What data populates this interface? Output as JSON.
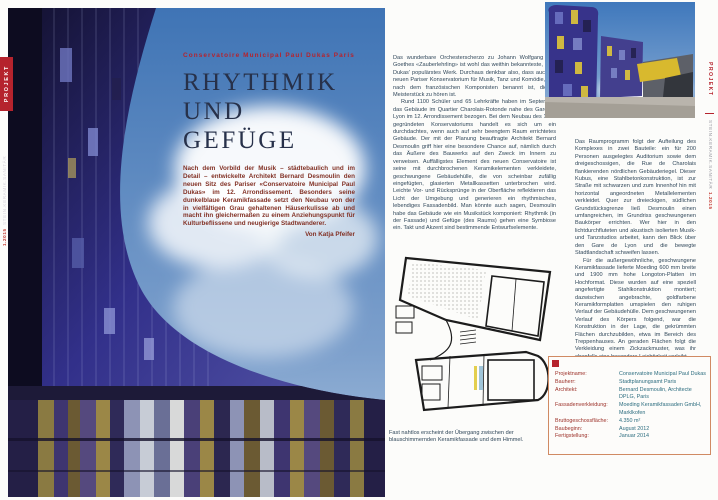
{
  "magazine": {
    "section_tab": "PROJEKT",
    "spine_name": "STEIN.KERAMIK.SANITÄR",
    "spine_issue": "1.2015"
  },
  "left_page": {
    "kicker": "Conservatoire Municipal Paul Dukas Paris",
    "title_line1": "RHYTHMIK",
    "title_line2": "UND GEFÜGE",
    "intro": "Nach dem Vorbild der Musik – städtebaulich und im Detail – entwickelte Architekt Bernard Desmoulin den neuen Sitz des Pariser «Conservatoire Municipal Paul Dukas» im 12. Arrondissement. Besonders seine dunkelblaue Keramikfassade setzt den Neubau von der in vielfältigen Grau gehaltenen Häuserkulisse ab und macht ihn gleichermaßen zu einem Anziehungspunkt für Kulturbeflissene und neugierige Stadtwanderer.",
    "byline": "Von Katja Pfeifer"
  },
  "right_page": {
    "col1_paras": [
      "Das wunderbare Orchesterscherzo zu Johann Wolfgang von Goethes «Zauberlehrling» ist wohl das weithin bekannteste, Paul Dukas' populärstes Werk. Durchaus denkbar also, dass auch im neuen Pariser Konservatorium für Musik, Tanz und Komödie, das nach dem französischen Komponisten benannt ist, dieses Meisterstück zu hören ist.",
      "Rund 1100 Schüler und 65 Lehrkräfte haben im September das Gebäude im Quartier Charolais-Rotonde nahe des Gare de Lyon im 12. Arrondissement bezogen. Bei dem Neubau des 1955 gegründeten Konservatoriums handelt es sich um ein durchdachtes, wenn auch auf sehr beengtem Raum errichtetes Gebäude. Der mit der Planung beauftragte Architekt Bernard Desmoulin griff hier eine besondere Chance auf, nämlich durch das Äußere des Bauwerks auf den Zweck im Innern zu verweisen. Auffälligstes Element des neuen Conservatoire ist seine mit durchbrochenen Keramikelementen verkleidete, geschwungene Gebäudehülle, die von scheinbar zufällig eingefügten, glasierten Metallkassetten unterbrochen wird. Leichte Vor- und Rücksprünge in der Oberfläche reflektieren das Licht der Umgebung und generieren ein rhythmisches, lebendiges Fassadenbild. Man könnte auch sagen, Desmoulin habe das Gebäude wie ein Musikstück komponiert: Rhythmik (in der Fassade) und Gefüge (des Raums) gehen eine Symbiose ein. Takt und Akzent sind bestimmende Entwurfselemente."
    ],
    "col2_paras": [
      "Das Raumprogramm folgt der Aufteilung des Komplexes in zwei Bauteile: ein für 200 Personen ausgelegtes Auditorium sowie dem dreigeschossigen, die Rue de Charolais flankierenden nördlichen Gebäuderiegel. Dieser Kubus, eine Stahlbetonkonstruktion, ist zur Straße mit schwarzen und zum Innenhof hin mit horizontal angeordneten Metallelementen verkleidet. Quer zur dreieckigen, südlichen Grundstücksgrenze ließ Desmoulin einen umfangreichen, im Grundriss geschwungenen Baukörper errichten. Wer hier in den lichtdurchfluteten und akustisch isolierten Musik- und Tanzstudios arbeitet, kann den Blick über den Gare de Lyon und die bewegte Stadtlandschaft schweifen lassen.",
      "Für die außergewöhnliche, geschwungene Keramikfassade lieferte Moeding 600 mm breite und 1900 mm hohe Longoton-Platten im Hochformat. Diese wurden auf eine speziell angefertigte Stahlkonstruktion montiert; dazwischen angebrachte, goldfarbene Keramikformplatten umspielen den ruhigen Verlauf der Gebäudehülle. Dem geschwungenen Verlauf des Körpers folgend, war die Konstruktion in der Lage, die gekrümmten Flächen durchzubilden, etwa im Bereich des Treppenhauses. An geraden Flächen folgt die Verkleidung einem Zickzackmuster, was ihr ebenfalls eine besondere Leichtigkeit verleiht.",
      "Das Motiv der verstreuten, goldfarbenen Metallpaneele – sie sind in der Verkleidung des Kubus vielfach vorhanden – unterstreicht den kompositorischen Charakter der Fassade. Das Gebäude lebt – wie die Musik, die es verkörpert."
    ],
    "caption": "Fast nahtlos erscheint der Übergang zwischen der blauschimmernden Keramikfassade und dem Himmel.",
    "infobox": {
      "rows": [
        {
          "label": "Projektname:",
          "value": "Conservatoire Municipal Paul Dukas"
        },
        {
          "label": "Bauherr:",
          "value": "Stadtplanungsamt Paris"
        },
        {
          "label": "Architekt:",
          "value": "Bernard Desmoulin, Architecte DPLG, Paris"
        },
        {
          "label": "Fassadenverkleidung:",
          "value": "Moeding Keramikfassaden GmbH, Marklkofen"
        },
        {
          "label": "Bruttogeschossfläche:",
          "value": "4.350 m²"
        },
        {
          "label": "Baubeginn:",
          "value": "August 2012"
        },
        {
          "label": "Fertigstellung:",
          "value": "Januar 2014"
        }
      ]
    }
  },
  "colors": {
    "accent_red": "#b5232d",
    "title_navy": "#27314a",
    "intro_maroon": "#823125",
    "body_text": "#30475a",
    "infobox_label": "#9c3028",
    "infobox_value": "#2e6e80",
    "infobox_border": "#d08a63",
    "facade_blue": "#2e2a6e",
    "sky_blue": "#3f74b5"
  }
}
